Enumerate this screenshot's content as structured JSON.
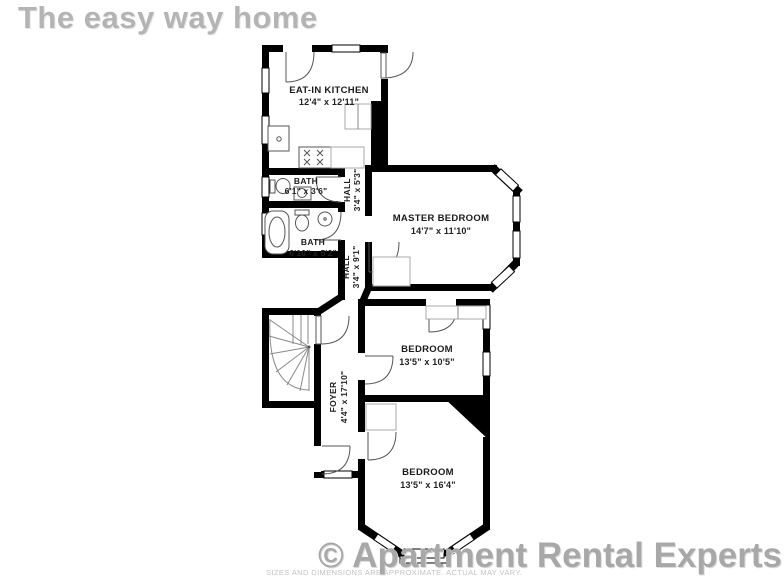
{
  "header": {
    "title": "The easy way home"
  },
  "footer": {
    "watermark": "© Apartment Rental Experts",
    "disclaimer": "SIZES AND DIMENSIONS ARE APPROXIMATE. ACTUAL MAY VARY."
  },
  "colors": {
    "wall": "#000000",
    "header_text": "#b4b4b4",
    "watermark_text": "#a8a8a8",
    "room_label": "#1b1b1b"
  },
  "rooms": {
    "kitchen": {
      "name": "EAT-IN KITCHEN",
      "dims": "12'4\" x 12'11\""
    },
    "bath1": {
      "name": "BATH",
      "dims": "6'1\" x 3'6\""
    },
    "bath2": {
      "name": "BATH",
      "dims": "6'10\" x 5'2\""
    },
    "hall1": {
      "name": "HALL",
      "dims": "3'4\" x 5'3\""
    },
    "hall2": {
      "name": "HALL",
      "dims": "3'4\" x 9'1\""
    },
    "master": {
      "name": "MASTER BEDROOM",
      "dims": "14'7\" x 11'10\""
    },
    "bedroom2": {
      "name": "BEDROOM",
      "dims": "13'5\" x 10'5\""
    },
    "bedroom3": {
      "name": "BEDROOM",
      "dims": "13'5\" x 16'4\""
    },
    "foyer": {
      "name": "FOYER",
      "dims": "4'4\" x 17'10\""
    }
  }
}
